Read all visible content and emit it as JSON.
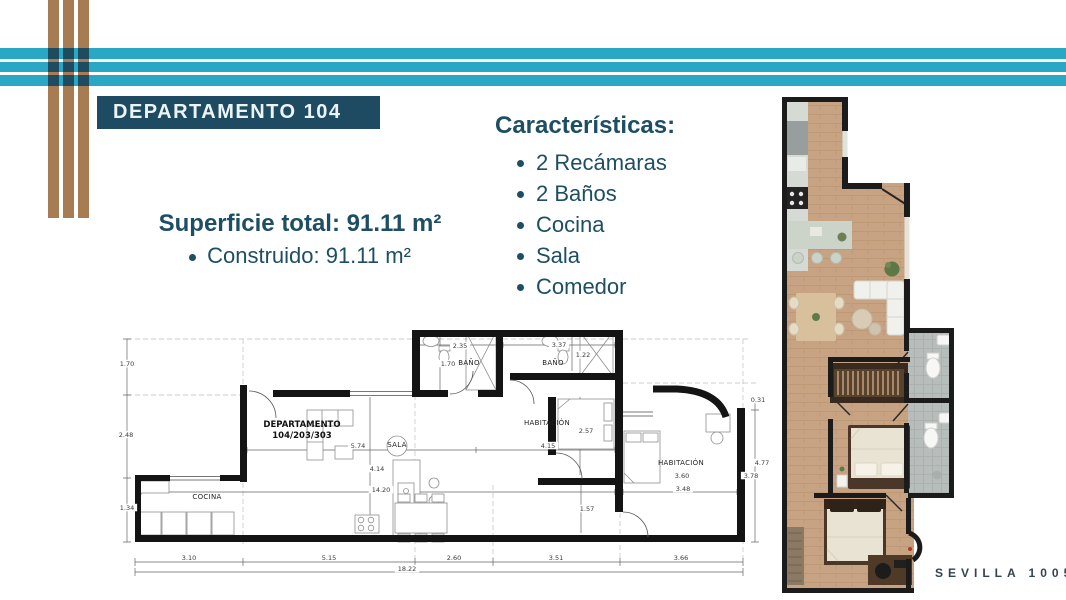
{
  "colors": {
    "cyan": "#29a8c6",
    "brown": "#a87c52",
    "navy": "#1e4b61",
    "heading_text": "#1d4e63",
    "wall": "#141414",
    "wood": "#c7a383",
    "bath_tile": "#b7bdbb"
  },
  "title": {
    "label": "DEPARTAMENTO 104"
  },
  "surface": {
    "heading": "Superficie total: 91.11 m²",
    "item": "Construido: 91.11 m²"
  },
  "features": {
    "heading": "Características:",
    "items": [
      "2 Recámaras",
      "2 Baños",
      "Cocina",
      "Sala",
      "Comedor"
    ]
  },
  "blueprint": {
    "room_labels": [
      {
        "t": "DEPARTAMENTO",
        "x": 192,
        "y": 112,
        "b": true
      },
      {
        "t": "104/203/303",
        "x": 192,
        "y": 123,
        "b": true
      },
      {
        "t": "SALA",
        "x": 287,
        "y": 132
      },
      {
        "t": "COCINA",
        "x": 97,
        "y": 184
      },
      {
        "t": "BAÑO",
        "x": 359,
        "y": 50
      },
      {
        "t": "BAÑO",
        "x": 443,
        "y": 50
      },
      {
        "t": "HABITACIÓN",
        "x": 437,
        "y": 110
      },
      {
        "t": "HABITACIÓN",
        "x": 571,
        "y": 150
      }
    ],
    "dim_labels": [
      {
        "t": "1.70",
        "x": 17,
        "y": 51
      },
      {
        "t": "2.48",
        "x": 16,
        "y": 122
      },
      {
        "t": "1.34",
        "x": 17,
        "y": 195
      },
      {
        "t": "2.35",
        "x": 350,
        "y": 33
      },
      {
        "t": "1.70",
        "x": 338,
        "y": 51
      },
      {
        "t": "3.37",
        "x": 449,
        "y": 32
      },
      {
        "t": "1.22",
        "x": 473,
        "y": 42
      },
      {
        "t": "5.74",
        "x": 248,
        "y": 133
      },
      {
        "t": "4.15",
        "x": 438,
        "y": 133
      },
      {
        "t": "4.14",
        "x": 267,
        "y": 156
      },
      {
        "t": "2.57",
        "x": 476,
        "y": 118
      },
      {
        "t": "14.20",
        "x": 271,
        "y": 177
      },
      {
        "t": "1.57",
        "x": 477,
        "y": 196
      },
      {
        "t": "3.60",
        "x": 572,
        "y": 163
      },
      {
        "t": "3.48",
        "x": 573,
        "y": 176
      },
      {
        "t": "0.31",
        "x": 648,
        "y": 87
      },
      {
        "t": "4.77",
        "x": 652,
        "y": 150
      },
      {
        "t": "3.78",
        "x": 641,
        "y": 163
      },
      {
        "t": "3.10",
        "x": 79,
        "y": 245
      },
      {
        "t": "5.15",
        "x": 219,
        "y": 245
      },
      {
        "t": "2.60",
        "x": 344,
        "y": 245
      },
      {
        "t": "3.51",
        "x": 446,
        "y": 245
      },
      {
        "t": "3.66",
        "x": 571,
        "y": 245
      },
      {
        "t": "18.22",
        "x": 297,
        "y": 256
      }
    ]
  },
  "render_plan": {
    "label": "SEVILLA 1005"
  }
}
